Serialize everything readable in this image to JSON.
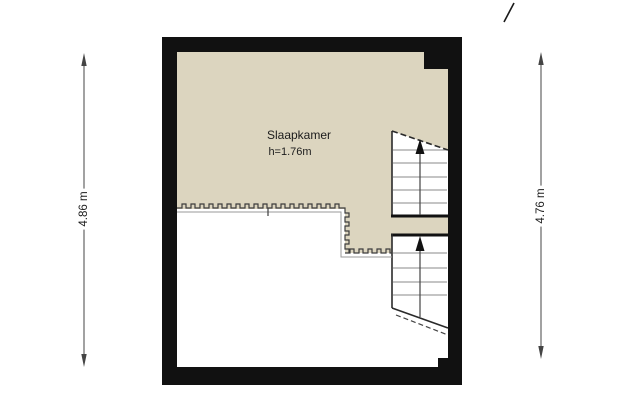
{
  "plan": {
    "room": {
      "name": "Slaapkamer",
      "height_label": "h=1.76m"
    },
    "stairs": [
      {
        "id": "upper",
        "arrow_icon": "up-arrow-icon",
        "direction": "up"
      },
      {
        "id": "lower",
        "arrow_icon": "up-arrow-icon",
        "direction": "up"
      }
    ],
    "colors": {
      "wall": "#111111",
      "room_fill": "#dcd5bf",
      "below_headroom_fill": "#ffffff",
      "tread_line": "#8a8a8a",
      "outline": "#2a2a2a",
      "dimension_line": "#444444"
    }
  },
  "dimensions": {
    "left_label": "4.86 m",
    "right_label": "4.76 m"
  }
}
